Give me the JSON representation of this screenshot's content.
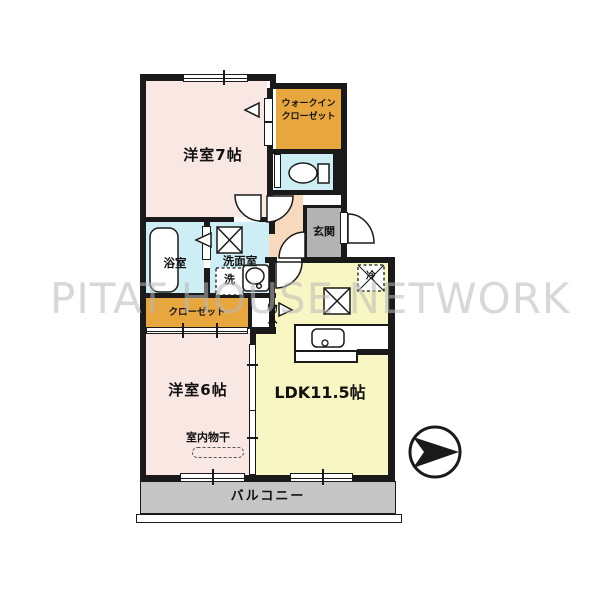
{
  "plan_type": "apartment-floorplan",
  "watermark": "PITAT HOUSE NETWORK",
  "rooms": {
    "bedroom7": {
      "label": "洋室7帖"
    },
    "walk_in_closet": {
      "label_line1": "ウォークイン",
      "label_line2": "クローゼット"
    },
    "entrance": {
      "label": "玄関"
    },
    "bath": {
      "label": "浴室"
    },
    "washroom": {
      "label": "洗面室"
    },
    "washer_space": {
      "label": "洗"
    },
    "closet": {
      "label": "クローゼット"
    },
    "storage": {
      "label": "物入"
    },
    "bedroom6": {
      "label": "洋室6帖"
    },
    "indoor_drying": {
      "label": "室内物干"
    },
    "ldk": {
      "label": "LDK11.5帖"
    },
    "refrigerator_space": {
      "label": "冷"
    },
    "balcony": {
      "label": "バルコニー"
    }
  },
  "colors": {
    "bedroom_pink": "#f9e7e4",
    "closet_orange": "#e7a73e",
    "water_blue": "#cdeef5",
    "hall_peach": "#f7d9bd",
    "entrance_gray": "#b3b3b3",
    "ldk_yellow": "#f8f6c2",
    "balcony_gray": "#c6c6c6",
    "wall_black": "#1a1a1a",
    "watermark_gray": "#b9b9b9"
  }
}
